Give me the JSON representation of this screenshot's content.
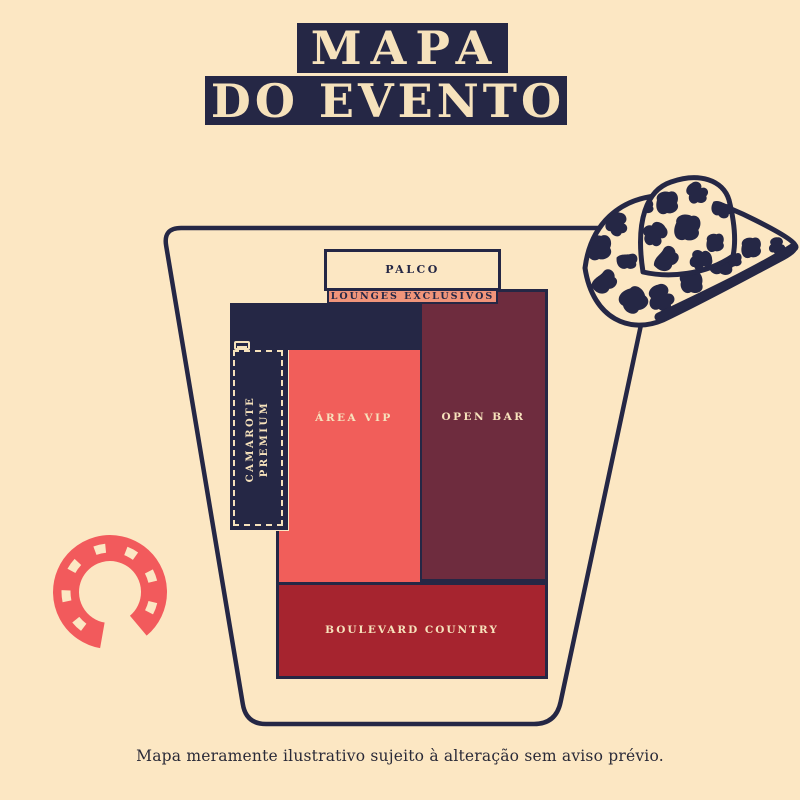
{
  "header": {
    "line1": "MAPA",
    "line2": "DO EVENTO"
  },
  "map": {
    "palco": {
      "label": "PALCO"
    },
    "lounges": {
      "label": "LOUNGES EXCLUSIVOS"
    },
    "camarote": {
      "line1": "CAMAROTE",
      "line2": "PREMIUM"
    },
    "area_vip": {
      "label": "ÁREA VIP"
    },
    "open_bar": {
      "label": "OPEN BAR"
    },
    "boulevard": {
      "label": "BOULEVARD COUNTRY"
    }
  },
  "footer": {
    "disclaimer": "Mapa meramente ilustrativo sujeito à alteração sem aviso prévio."
  },
  "icons": {
    "hat": "cow-print-cowboy-hat-icon",
    "horseshoe": "horseshoe-icon",
    "camarote_marker": "bench-icon"
  },
  "colors": {
    "background": "#fce7c3",
    "navy": "#252745",
    "cream": "#f6e2bc",
    "coral": "#f15e5a",
    "salmon": "#f0947a",
    "maroon": "#6e2c3e",
    "red": "#a6242f",
    "horseshoe": "#f25a5c",
    "text-dark": "#2a2a38"
  }
}
